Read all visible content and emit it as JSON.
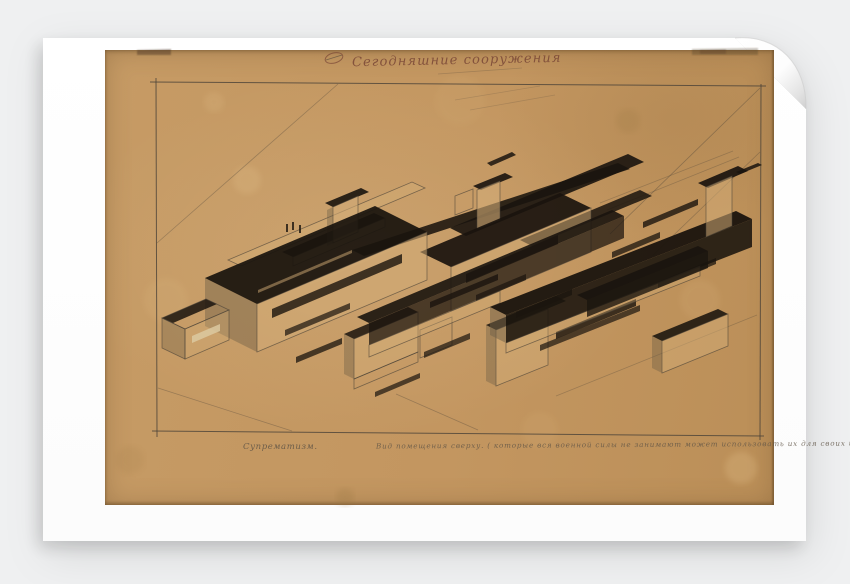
{
  "scene": {
    "colors": {
      "background": "#eff0f1",
      "sheet": "#ffffff",
      "paper": "#c49a66",
      "paper_edge": "#8a6a42",
      "pencil": "#4a4238",
      "ink_black": "#1a140e",
      "title_ink": "#7c4a38",
      "caption_pencil": "#5f5446",
      "shade": "#6f6047",
      "light_face": "#d2ac76"
    }
  },
  "artwork": {
    "title_inscription": "Сегодняшние сооружения",
    "caption_left": "Супрематизм.",
    "caption_right": "Вид помещения сверху. ( которые вся военной силы не занимают может использовать их для своих целей )",
    "lines": [
      {
        "p": [
          150,
          82,
          766,
          86
        ],
        "o": 0.8,
        "w": 1
      },
      {
        "p": [
          761,
          84,
          760,
          440
        ],
        "o": 0.8,
        "w": 1
      },
      {
        "p": [
          152,
          431,
          764,
          436
        ],
        "o": 0.8,
        "w": 1
      },
      {
        "p": [
          156,
          78,
          157,
          437
        ],
        "o": 0.8,
        "w": 1
      },
      {
        "p": [
          157,
          243,
          338,
          84
        ],
        "o": 0.35,
        "w": 0.8
      },
      {
        "p": [
          760,
          88,
          610,
          234
        ],
        "o": 0.4,
        "w": 0.8
      },
      {
        "p": [
          760,
          152,
          652,
          256
        ],
        "o": 0.35,
        "w": 0.8
      },
      {
        "p": [
          158,
          388,
          292,
          431
        ],
        "o": 0.35,
        "w": 0.8
      },
      {
        "p": [
          396,
          394,
          478,
          430
        ],
        "o": 0.35,
        "w": 0.8
      },
      {
        "p": [
          556,
          396,
          757,
          315
        ],
        "o": 0.3,
        "w": 0.8
      },
      {
        "p": [
          600,
          203,
          733,
          151
        ],
        "o": 0.3,
        "w": 0.8
      },
      {
        "p": [
          607,
          210,
          739,
          157
        ],
        "o": 0.3,
        "w": 0.8
      },
      {
        "p": [
          455,
          100,
          540,
          86
        ],
        "o": 0.2,
        "w": 0.8
      },
      {
        "p": [
          470,
          110,
          555,
          95
        ],
        "o": 0.2,
        "w": 0.8
      },
      {
        "p": [
          438,
          74,
          522,
          68
        ],
        "o": 0.25,
        "w": 0.8
      },
      {
        "p": [
          326,
          60,
          342,
          55
        ],
        "o": 0.6,
        "w": 0.9
      }
    ],
    "shapes": [
      {
        "p": "228,260 412,182 425,188 241,266",
        "f": "LP",
        "o": 0.45,
        "st": 1
      },
      {
        "p": "282,252 374,213 385,218 293,257",
        "f": "B",
        "o": 0.88
      },
      {
        "p": "293,257 385,218 385,227 293,266",
        "f": "LP",
        "o": 0.5,
        "st": 1
      },
      {
        "p": "286,224 288,224 288,232 286,232",
        "f": "B",
        "o": 0.8
      },
      {
        "p": "292,222 294,222 294,230 292,230",
        "f": "B",
        "o": 0.8
      },
      {
        "p": "299,225 301,225 301,233 299,233",
        "f": "B",
        "o": 0.8
      },
      {
        "p": "325,203 361,188 369,192 333,207",
        "f": "B",
        "o": 0.9
      },
      {
        "p": "333,207 358,196 358,232 333,243",
        "f": "LP",
        "o": 0.6,
        "st": 1
      },
      {
        "p": "327,210 333,207 333,243 327,246",
        "f": "SH",
        "o": 0.4
      },
      {
        "p": "352,250 618,163 630,169 364,256",
        "f": "B",
        "o": 0.88
      },
      {
        "p": "450,228 628,154 644,162 466,236",
        "f": "B",
        "o": 0.9
      },
      {
        "p": "520,240 640,190 652,196 532,246",
        "f": "B",
        "o": 0.85
      },
      {
        "p": "473,186 505,173 513,177 481,190",
        "f": "B",
        "o": 0.9
      },
      {
        "p": "477,190 500,181 500,220 477,229",
        "f": "LP",
        "o": 0.6,
        "st": 1
      },
      {
        "p": "487,163 512,152 516,155 491,166",
        "f": "B",
        "o": 0.85
      },
      {
        "p": "455,196 473,189 473,208 455,215",
        "f": "none",
        "o": 1,
        "st": 1
      },
      {
        "p": "420,252 560,193 591,208 451,267",
        "f": "B",
        "o": 0.92
      },
      {
        "p": "451,267 591,208 591,252 451,311",
        "f": "LP",
        "o": 0.5,
        "st": 1
      },
      {
        "p": "466,274 558,235 558,244 466,283",
        "f": "B",
        "o": 0.8
      },
      {
        "p": "476,295 526,274 526,280 476,301",
        "f": "B",
        "o": 0.7
      },
      {
        "p": "205,278 257,304 257,352 205,326",
        "f": "SH",
        "o": 0.45
      },
      {
        "p": "205,278 375,206 427,232 257,304",
        "f": "B",
        "o": 0.93
      },
      {
        "p": "258,290 352,250 352,253 258,293",
        "f": "LP",
        "o": 0.5
      },
      {
        "p": "310,282 400,244 400,247 310,285",
        "f": "LP",
        "o": 0.4
      },
      {
        "p": "257,304 427,232 427,280 257,352",
        "f": "LP",
        "o": 0.55,
        "st": 1
      },
      {
        "p": "272,309 402,254 402,263 272,318",
        "f": "B",
        "o": 0.8
      },
      {
        "p": "285,330 350,303 350,309 285,336",
        "f": "B",
        "o": 0.7
      },
      {
        "p": "162,318 206,299 217,304 173,323",
        "f": "B",
        "o": 0.85
      },
      {
        "p": "162,318 206,299 229,310 185,329",
        "f": "none",
        "o": 1,
        "st": 1
      },
      {
        "p": "185,329 229,310 229,340 185,359",
        "f": "LP",
        "o": 0.35,
        "st": 1
      },
      {
        "p": "192,336 220,324 220,331 192,343",
        "f": "#dcc9a0",
        "o": 0.85
      },
      {
        "p": "162,318 185,329 185,359 162,348",
        "f": "SH",
        "o": 0.35,
        "st": 1
      },
      {
        "p": "430,302 498,274 498,280 430,308",
        "f": "B",
        "o": 0.8
      },
      {
        "p": "516,312 572,289 572,295 516,318",
        "f": "B",
        "o": 0.75
      },
      {
        "p": "556,332 636,299 636,306 556,339",
        "f": "B",
        "o": 0.8
      },
      {
        "p": "612,252 660,232 660,238 612,258",
        "f": "B",
        "o": 0.75
      },
      {
        "p": "643,222 698,199 698,205 643,228",
        "f": "B",
        "o": 0.8
      },
      {
        "p": "658,282 716,258 716,264 658,288",
        "f": "B",
        "o": 0.75
      },
      {
        "p": "344,334 408,307 418,312 354,339",
        "f": "B",
        "o": 0.85
      },
      {
        "p": "354,339 418,312 418,352 354,379",
        "f": "LP",
        "o": 0.5,
        "st": 1
      },
      {
        "p": "354,379 418,352 418,362 354,389",
        "f": "none",
        "o": 1,
        "st": 1
      },
      {
        "p": "344,334 354,339 354,379 344,374",
        "f": "SH",
        "o": 0.4
      },
      {
        "p": "420,330 452,317 452,345 420,358",
        "f": "none",
        "o": 1,
        "st": 1
      },
      {
        "p": "424,352 470,333 470,339 424,358",
        "f": "B",
        "o": 0.7
      },
      {
        "p": "357,317 612,210 624,216 369,323",
        "f": "B",
        "o": 0.9
      },
      {
        "p": "369,323 624,216 624,238 369,345",
        "f": "B",
        "o": 0.72
      },
      {
        "p": "369,345 500,291 500,303 369,357",
        "f": "LP",
        "o": 0.4,
        "st": 1
      },
      {
        "p": "486,325 556,296 566,301 496,330",
        "f": "B",
        "o": 0.85
      },
      {
        "p": "496,330 548,309 548,365 496,386",
        "f": "LP",
        "o": 0.5,
        "st": 1
      },
      {
        "p": "486,325 496,330 496,386 486,381",
        "f": "SH",
        "o": 0.4
      },
      {
        "p": "490,307 736,211 752,219 506,315",
        "f": "B",
        "o": 0.95
      },
      {
        "p": "506,315 752,219 752,247 506,343",
        "f": "B",
        "o": 0.88
      },
      {
        "p": "490,307 506,315 506,343 490,335",
        "f": "SH",
        "o": 0.5
      },
      {
        "p": "506,343 700,266 700,276 506,353",
        "f": "LP",
        "o": 0.35,
        "st": 1
      },
      {
        "p": "540,345 640,305 640,311 540,351",
        "f": "B",
        "o": 0.7
      },
      {
        "p": "577,295 698,246 708,251 587,300",
        "f": "B",
        "o": 0.9
      },
      {
        "p": "587,300 708,251 708,268 587,317",
        "f": "B",
        "o": 0.78
      },
      {
        "p": "698,183 738,166 748,171 708,188",
        "f": "B",
        "o": 0.92
      },
      {
        "p": "706,187 732,176 732,226 706,237",
        "f": "LP",
        "o": 0.55,
        "st": 1
      },
      {
        "p": "736,172 758,163 762,165 740,174",
        "f": "B",
        "o": 0.85
      },
      {
        "p": "652,336 718,309 728,314 662,341",
        "f": "B",
        "o": 0.88
      },
      {
        "p": "662,341 728,314 728,346 662,373",
        "f": "LP",
        "o": 0.5,
        "st": 1
      },
      {
        "p": "652,336 662,341 662,373 652,368",
        "f": "SH",
        "o": 0.4
      },
      {
        "p": "296,357 342,338 342,344 296,363",
        "f": "B",
        "o": 0.75
      },
      {
        "p": "375,392 420,373 420,378 375,397",
        "f": "B",
        "o": 0.7
      },
      {
        "p": "137,50 171,49 171,55 137,55",
        "f": "#4a3522",
        "o": 0.45,
        "fl": 1
      },
      {
        "p": "692,49 758,48 758,55 692,55",
        "f": "#4a3522",
        "o": 0.3,
        "fl": 1
      },
      {
        "p": "700,50 726,49 726,54 700,54",
        "f": "#4a3522",
        "o": 0.25,
        "fl": 1
      },
      {
        "e": [
          334,
          58,
          9,
          5,
          -15
        ],
        "o": 0.75
      }
    ],
    "stains": [
      [
        247,
        180,
        14,
        "#e2c08a",
        0.25
      ],
      [
        214,
        102,
        10,
        "#e2c08a",
        0.2
      ],
      [
        628,
        121,
        12,
        "#96743f",
        0.18
      ],
      [
        166,
        300,
        22,
        "#dcb87f",
        0.18
      ],
      [
        345,
        497,
        9,
        "#96743f",
        0.22
      ],
      [
        741,
        468,
        16,
        "#e2c08a",
        0.28
      ],
      [
        540,
        430,
        18,
        "#dcb87f",
        0.12
      ],
      [
        460,
        100,
        25,
        "#dcb87f",
        0.1
      ],
      [
        700,
        300,
        20,
        "#e2c08a",
        0.12
      ],
      [
        130,
        460,
        14,
        "#96743f",
        0.12
      ]
    ]
  }
}
